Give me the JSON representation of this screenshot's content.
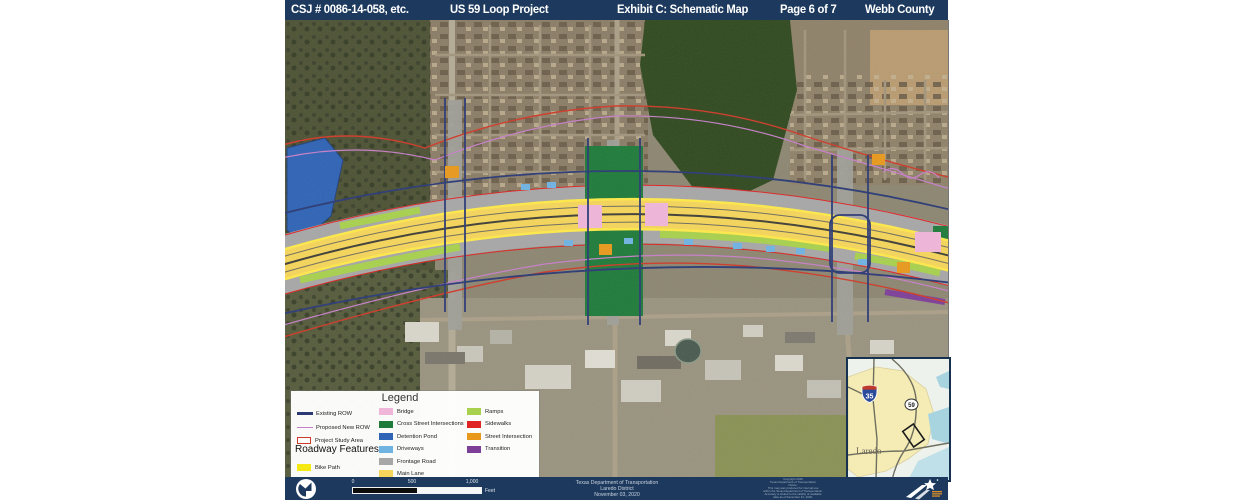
{
  "theme": {
    "header_bg": "#1d3a5e",
    "footer_bg": "#1d3a5e"
  },
  "header": {
    "csj": "CSJ # 0086-14-058, etc.",
    "project": "US 59 Loop Project",
    "exhibit": "Exhibit C: Schematic Map",
    "page": "Page 6 of 7",
    "county": "Webb County"
  },
  "legend": {
    "title": "Legend",
    "line_items": [
      {
        "label": "Existing ROW",
        "color": "#2b3a75"
      },
      {
        "label": "Proposed New ROW",
        "color": "#c77fc9"
      },
      {
        "label": "Project Study Area",
        "color": "#cf3a28"
      }
    ],
    "roadway_title": "Roadway Features",
    "roadway_items": [
      {
        "label": "Bike Path",
        "color": "#f4e915"
      }
    ],
    "area_items": [
      {
        "label": "Bridge",
        "color": "#f0b6d9"
      },
      {
        "label": "Cross Street Intersections",
        "color": "#1e7b39"
      },
      {
        "label": "Detention Pond",
        "color": "#2e63b5"
      },
      {
        "label": "Driveways",
        "color": "#6fb3e3"
      },
      {
        "label": "Frontage Road",
        "color": "#a7a7a7"
      },
      {
        "label": "Main Lane",
        "color": "#f5d55a"
      }
    ],
    "area_items2": [
      {
        "label": "Ramps",
        "color": "#a8d14d"
      },
      {
        "label": "Sidewalks",
        "color": "#e02424"
      },
      {
        "label": "Street Intersection",
        "color": "#e8991c"
      },
      {
        "label": "Transition",
        "color": "#7d3f98"
      }
    ]
  },
  "scalebar": {
    "start": "0",
    "mid": "500",
    "end": "1,000",
    "unit": "Feet"
  },
  "footer": {
    "agency": "Texas Department of Transportation",
    "district": "Laredo District",
    "date": "November 03, 2020",
    "fine_print": "Copyright 2020\nTexas Department of Transportation\nNotice:\nThis map was produced for internal use\nwithin the Texas Department of Transportation.\nAccuracy is limited to the validity of available\ndata as of December 31, 2020."
  },
  "inset": {
    "city_label": "Laredo",
    "interstate": "35",
    "us_route": "59"
  }
}
